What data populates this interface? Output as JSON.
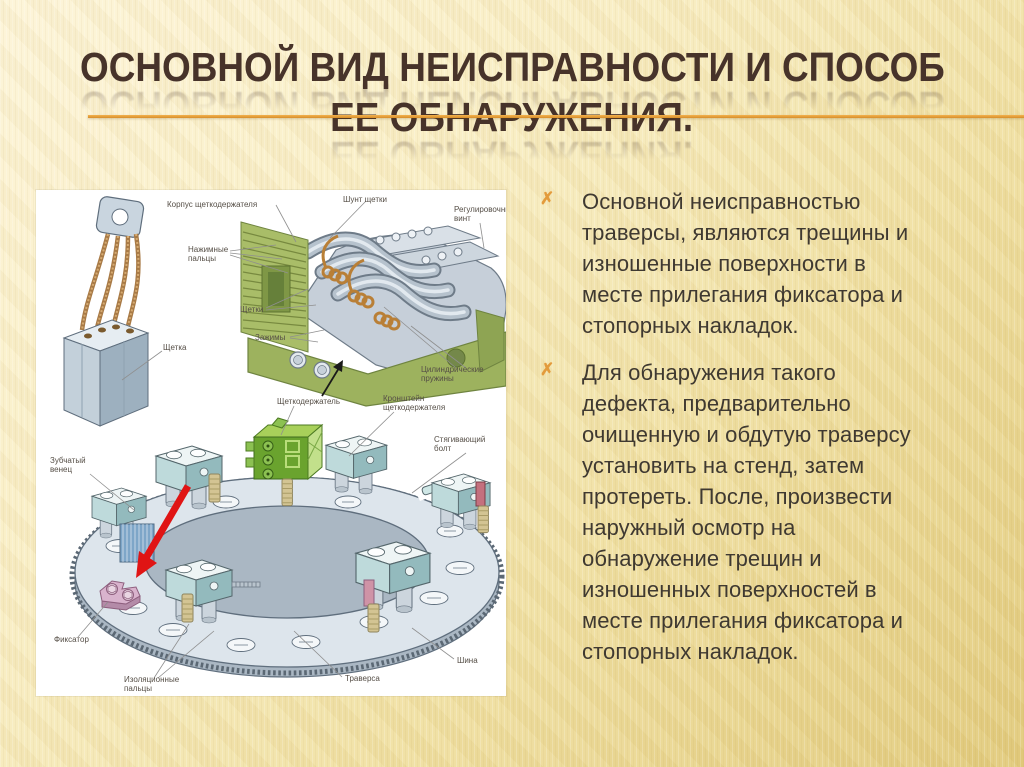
{
  "title": {
    "line1": "ОСНОВНОЙ ВИД НЕИСПРАВНОСТИ И СПОСОБ",
    "line2": "ЕЕ ОБНАРУЖЕНИЯ."
  },
  "bullets": {
    "marker_char": "✗",
    "items": [
      {
        "text": "Основной неисправностью\nтраверсы, являются трещины и\nизношенные поверхности в\nместе прилегания фиксатора и\nстопорных накладок."
      },
      {
        "text": "Для обнаружения такого\nдефекта, предварительно\nочищенную и обдутую траверсу\nустановить на стенд, затем\nпротереть. После, произвести\nнаружный осмотр на\nобнаружение  трещин и\nизношенных поверхностей в\nместе прилегания фиксатора и\nстопорных накладок."
      }
    ]
  },
  "diagram": {
    "labels": {
      "korpus": "Корпус щеткодержателя",
      "shunt": "Шунт щетки",
      "regulir": [
        "Регулировочный",
        "винт"
      ],
      "nazhim": [
        "Нажимные",
        "пальцы"
      ],
      "shchetki": "Щетки",
      "zazhimy": "Зажимы",
      "shchetka": "Щетка",
      "pruzhiny": [
        "Цилиндрические",
        "пружины"
      ],
      "holder": "Щеткодержатель",
      "kronshtein": [
        "Кронштейн",
        "щеткодержателя"
      ],
      "zubchaty": [
        "Зубчатый",
        "венец"
      ],
      "bolt": [
        "Стягивающий",
        "болт"
      ],
      "fiksator": "Фиксатор",
      "izol": [
        "Изоляционные",
        "пальцы"
      ],
      "traversa": "Траверса",
      "shina": "Шина"
    }
  },
  "colors": {
    "accent_line": "#e2a23c",
    "bullet_marker": "#e39b3c",
    "title_text": "#47332a",
    "body_text": "#3f3931",
    "panel_bg": "#ffffff",
    "slide_bg_top": "#fdf5d8",
    "slide_bg_bottom": "#e2cb7d",
    "arrow_red": "#e01414",
    "diagram_green": "#9db25e",
    "diagram_bright_green": "#6aa32e",
    "diagram_blue_gray": "#bedadb",
    "diagram_copper": "#b97f36",
    "diagram_pink": "#d9b3cd"
  }
}
